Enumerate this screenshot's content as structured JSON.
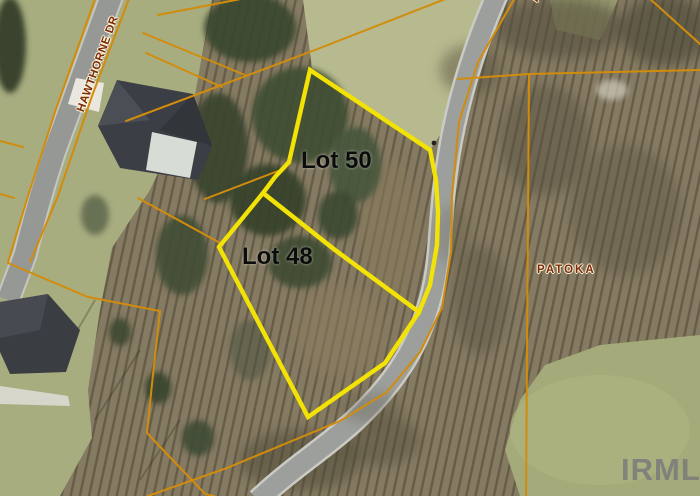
{
  "map": {
    "labels": {
      "street": "HAWTHORNE DR",
      "street_partial": "P",
      "lot50": "Lot 50",
      "lot48": "Lot 48",
      "area": "PATOKA",
      "watermark": "IRMLS"
    },
    "colors": {
      "highlight_parcel_yellow": "#f2e205",
      "parcel_line_orange": "#d28c0c",
      "street_label_maroon": "#7c2a0d",
      "lot_label_black": "#0c0c0c",
      "watermark_gray": "#7a7a7a",
      "road_gray": "#9d9f9c",
      "grass_green": "#a8ad80",
      "woods_brown": "#857a62"
    }
  }
}
